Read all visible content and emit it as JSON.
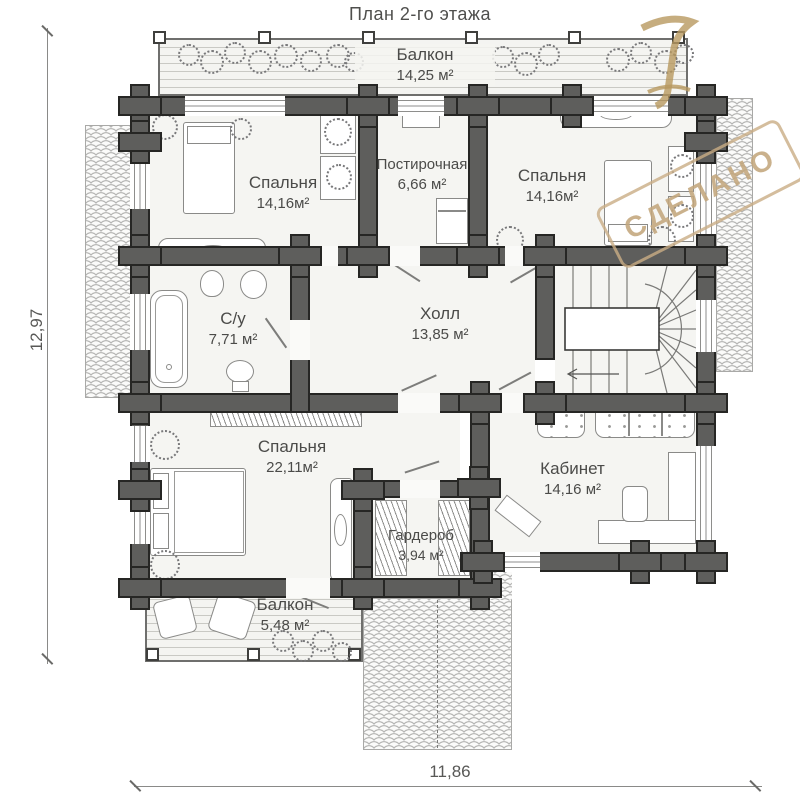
{
  "title": "План 2-го этажа",
  "watermark": "СДЕЛАНО",
  "dimensions": {
    "left": "12,97",
    "bottom": "11,86"
  },
  "rooms": {
    "balcony_top": {
      "name": "Балкон",
      "area": "14,25 м²"
    },
    "bedroom_tl": {
      "name": "Спальня",
      "area": "14,16м²"
    },
    "laundry": {
      "name": "Постирочная",
      "area": "6,66 м²"
    },
    "bedroom_tr": {
      "name": "Спальня",
      "area": "14,16м²"
    },
    "bathroom": {
      "name": "С/у",
      "area": "7,71 м²"
    },
    "hall": {
      "name": "Холл",
      "area": "13,85 м²"
    },
    "bedroom_bottom": {
      "name": "Спальня",
      "area": "22,11м²"
    },
    "wardrobe": {
      "name": "Гардероб",
      "area": "3,94 м²"
    },
    "office": {
      "name": "Кабинет",
      "area": "14,16 м²"
    },
    "balcony_bottom": {
      "name": "Балкон",
      "area": "5,48 м²"
    }
  },
  "colors": {
    "wall": "#5e5e5c",
    "floor": "#f5f5f2",
    "stamp_tan": "#c9ad85",
    "text": "#4b4b49"
  }
}
